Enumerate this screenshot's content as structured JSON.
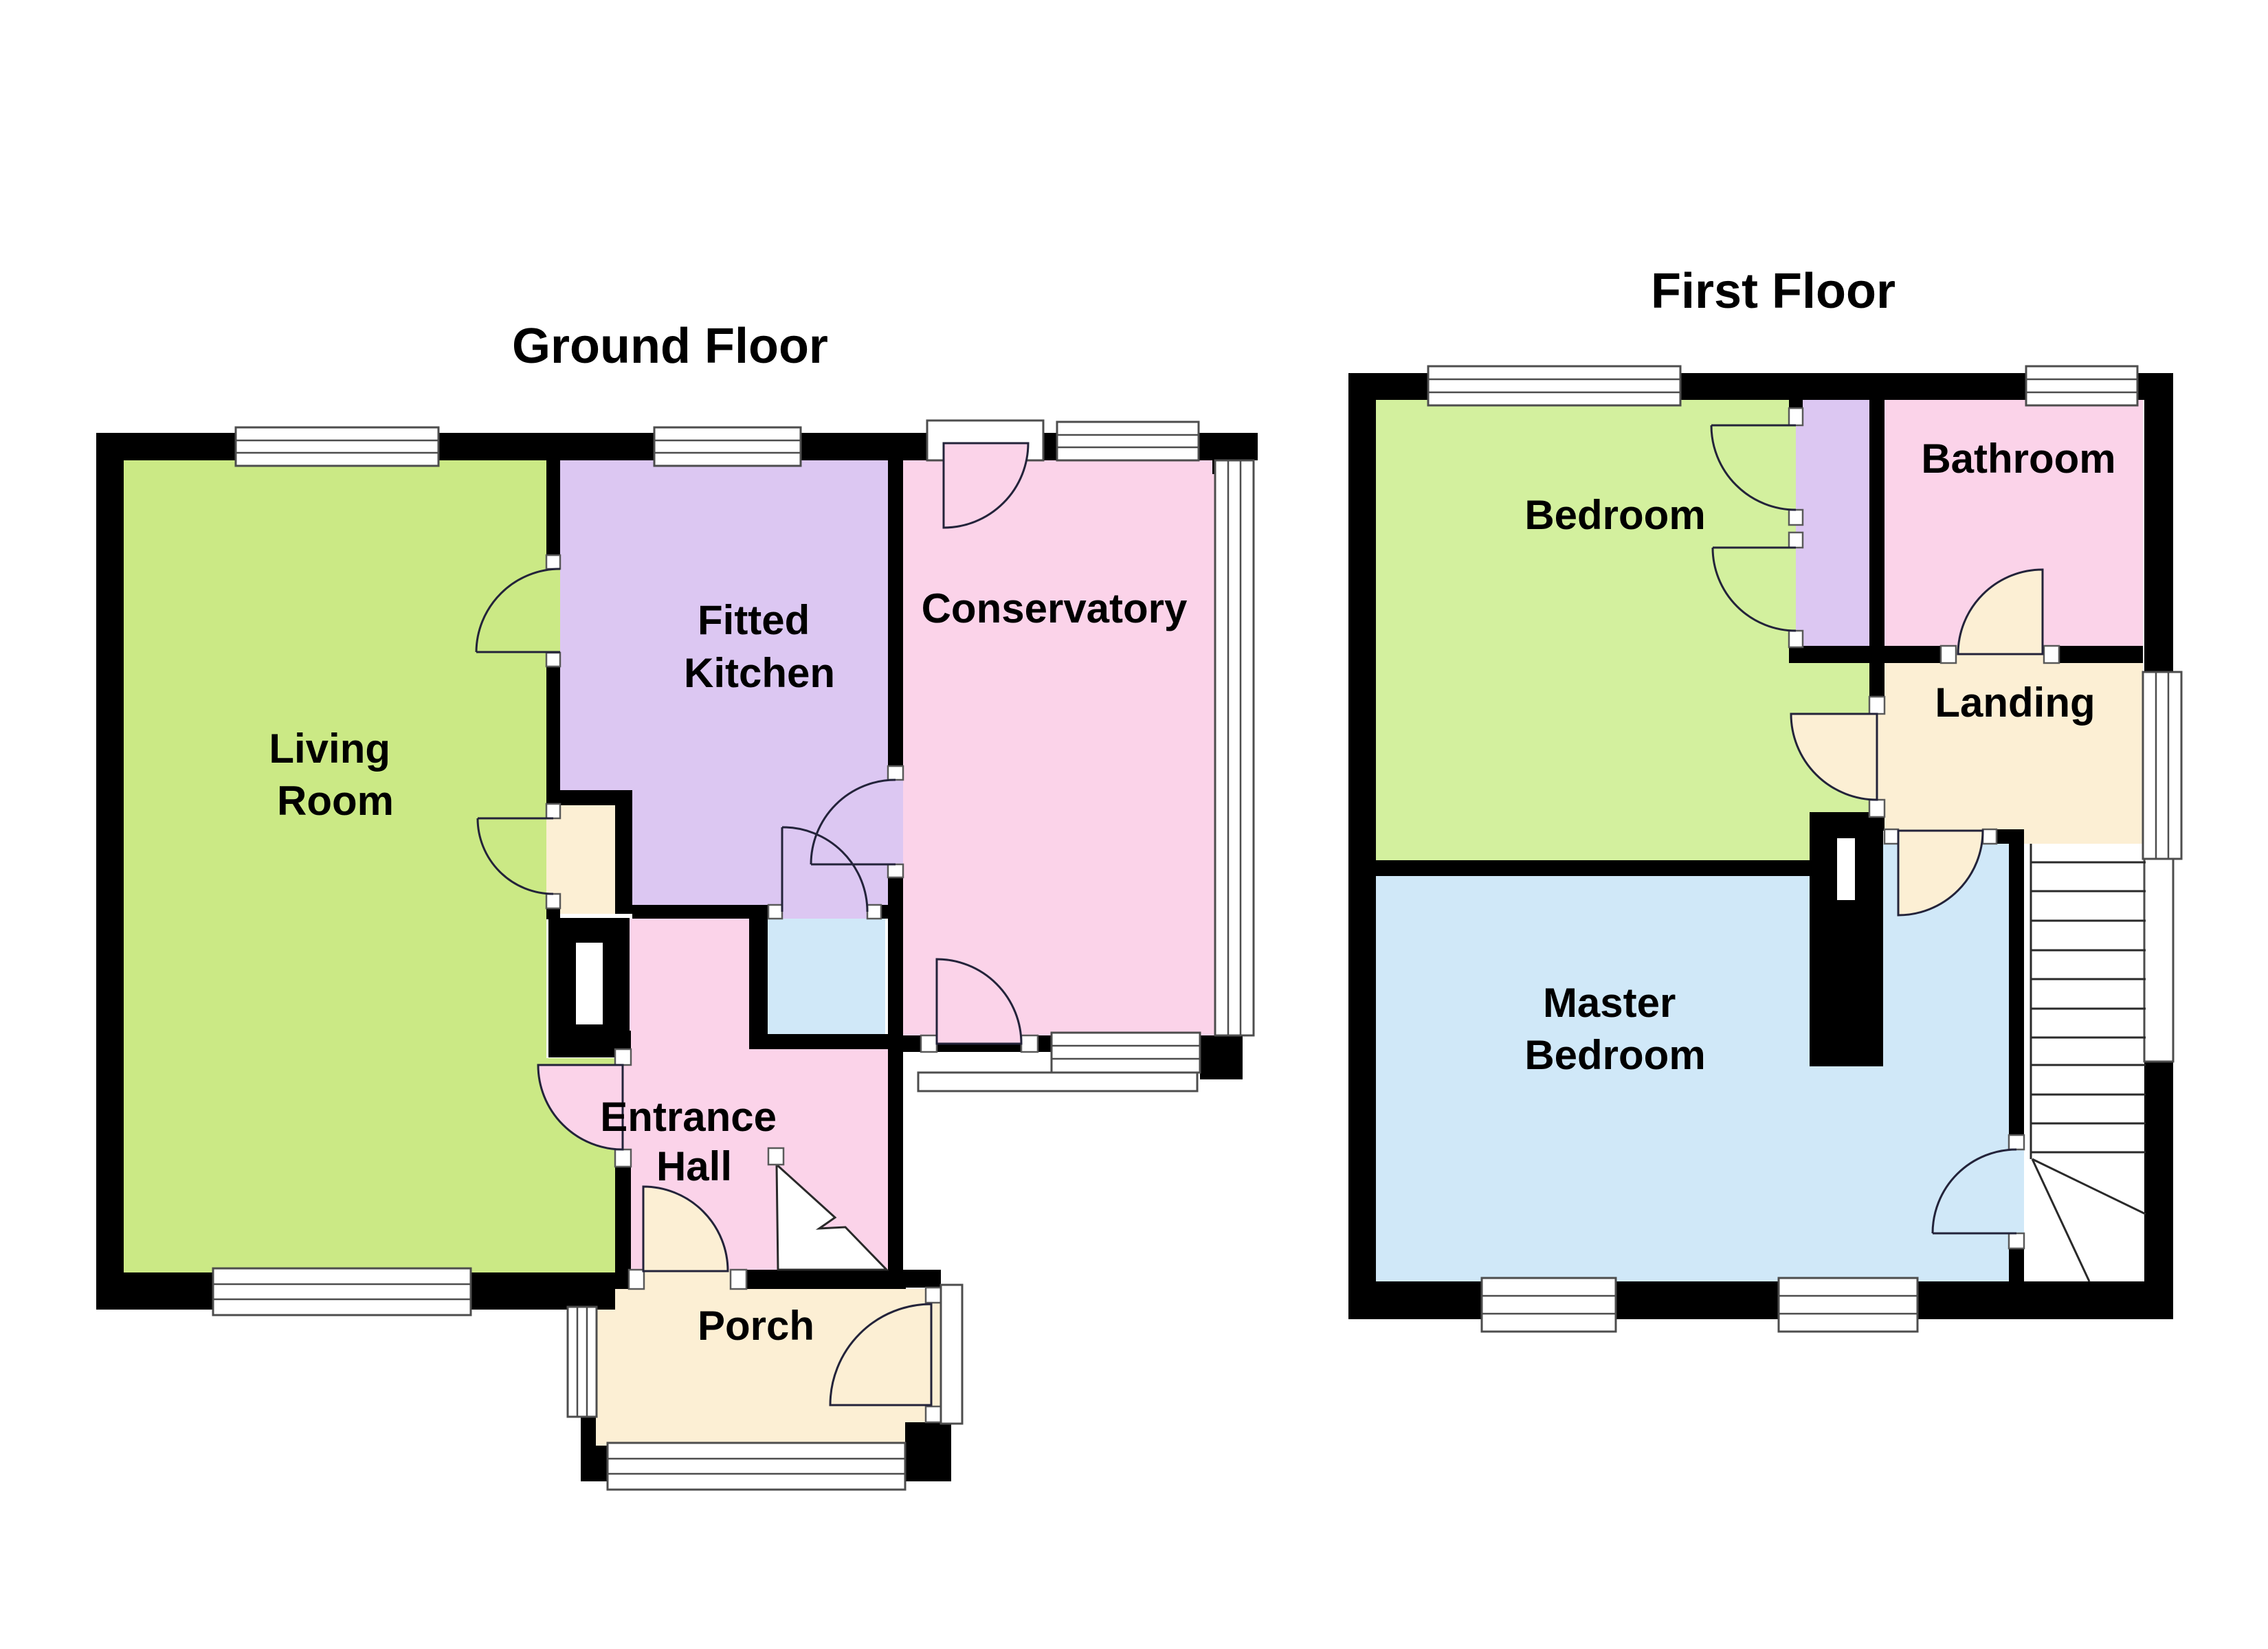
{
  "page": {
    "background": "#ffffff"
  },
  "ground_floor": {
    "title": "Ground Floor",
    "labels": {
      "living_room": [
        "Living",
        "Room"
      ],
      "fitted_kitchen": [
        "Fitted",
        "Kitchen"
      ],
      "conservatory": [
        "Conservatory"
      ],
      "entrance_hall": [
        "Entrance",
        "Hall"
      ],
      "porch": [
        "Porch"
      ]
    }
  },
  "first_floor": {
    "title": "First Floor",
    "labels": {
      "bedroom": [
        "Bedroom"
      ],
      "bathroom": [
        "Bathroom"
      ],
      "landing": [
        "Landing"
      ],
      "master_bedroom": [
        "Master",
        "Bedroom"
      ]
    }
  },
  "colors": {
    "green_ground": "#cbe985",
    "green_first": "#d3f09e",
    "purple": "#dcc7f2",
    "pink": "#fbd3e9",
    "cream": "#fcefd4",
    "blue": "#d0e8f8",
    "wall": "#000000",
    "window_trim": "#4d4d4d"
  }
}
